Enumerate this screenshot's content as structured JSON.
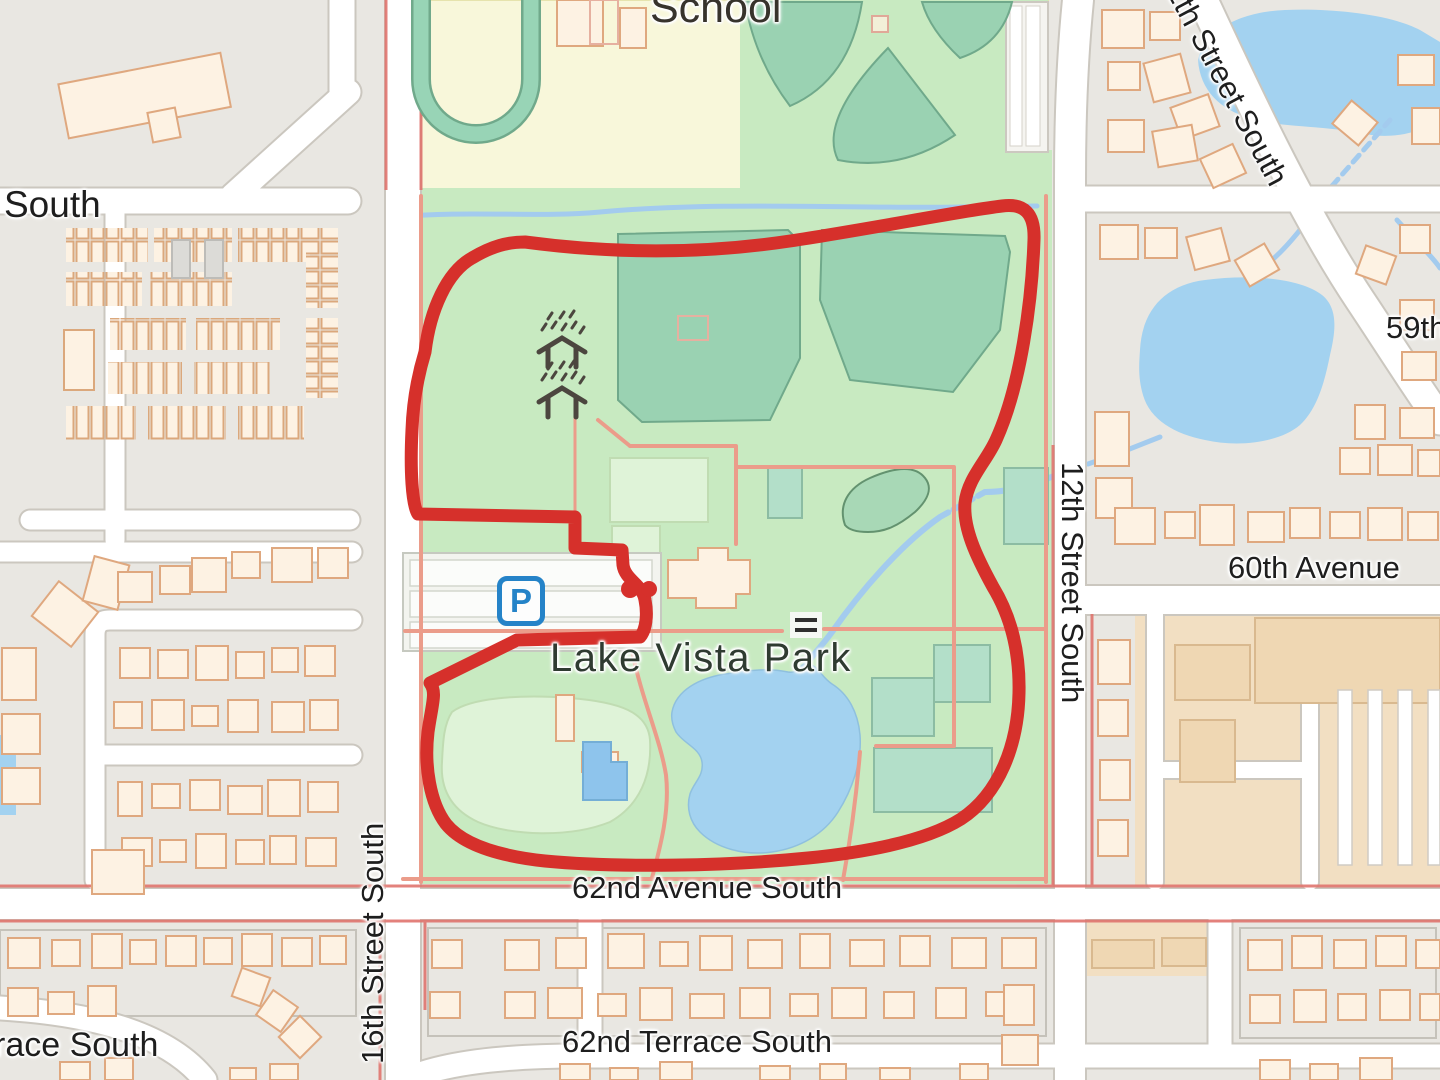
{
  "map": {
    "place_labels": {
      "school": "School",
      "park": "Lake Vista Park"
    },
    "street_labels": {
      "south_fragment": "South",
      "th_fragment": "th",
      "street_11th": "11th Street South",
      "label_59th": "59th",
      "street_12th": "12th Street South",
      "avenue_60th": "60th Avenue",
      "street_16th": "16th Street South",
      "avenue_62nd": "62nd Avenue South",
      "terrace_62nd": "62nd Terrace South",
      "terrace_fragment": "race South"
    },
    "icons": {
      "parking_letter": "P",
      "power_tower": "power-tower-icon",
      "bridge": "bridge-icon"
    },
    "colors": {
      "track_red": "#d6302b",
      "water_blue": "#a3d2f0",
      "park_green": "#c8eac1",
      "sports_teal": "#9ad2b2",
      "school_yellow": "#f8f7da",
      "residential_gray": "#e9e7e2",
      "commercial_tan": "#f2dfc2",
      "building_cream": "#fdf2e3",
      "path_salmon": "#eb9c8a",
      "parking_blue": "#2583c8"
    }
  }
}
